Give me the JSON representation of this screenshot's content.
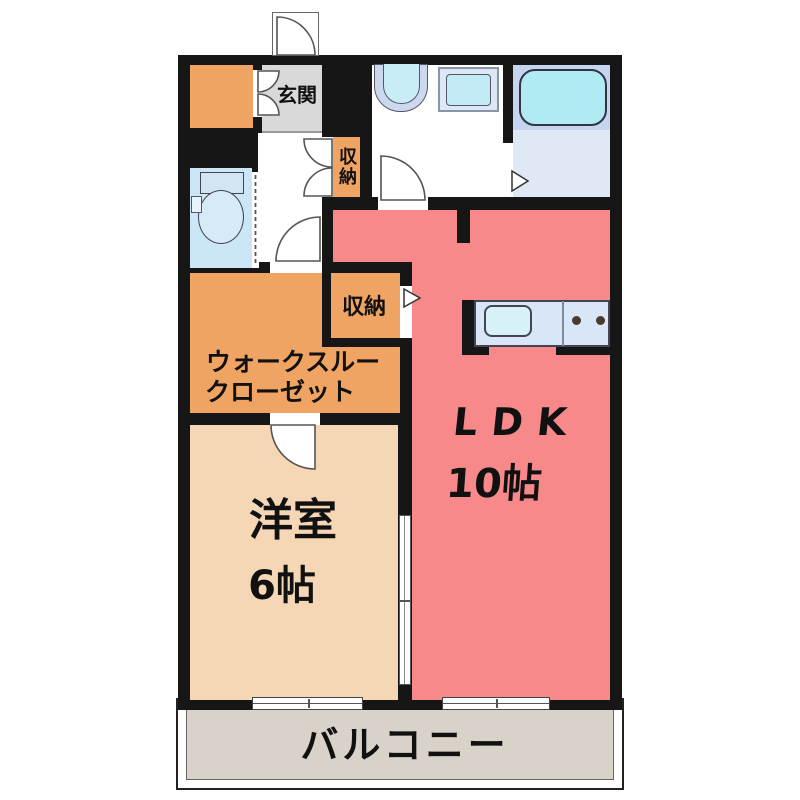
{
  "plan": {
    "labels": {
      "genkan": "玄関",
      "storage1": "収納",
      "storage2": "収納",
      "closet_line1": "ウォークスルー",
      "closet_line2": "クローゼット",
      "bedroom_name": "洋室",
      "bedroom_size": "6帖",
      "ldk_name": "LDK",
      "ldk_size": "10帖",
      "balcony": "バルコニー"
    },
    "colors": {
      "wall": "#161616",
      "ldk": "#f8898b",
      "bedroom": "#f5d6b5",
      "orange": "#efa463",
      "genkan": "#d9d9d9",
      "toilet_room": "#cbe6f6",
      "bath_deck": "#c5d5ef",
      "bath_floor": "#dfe9f6",
      "bathtub": "#b0ebf4",
      "kitchen_counter": "#d8e6f8",
      "kitchen_sink": "#d6f1f7",
      "fixture": "#c3ebf6",
      "balcony": "#d9d2c8"
    }
  }
}
